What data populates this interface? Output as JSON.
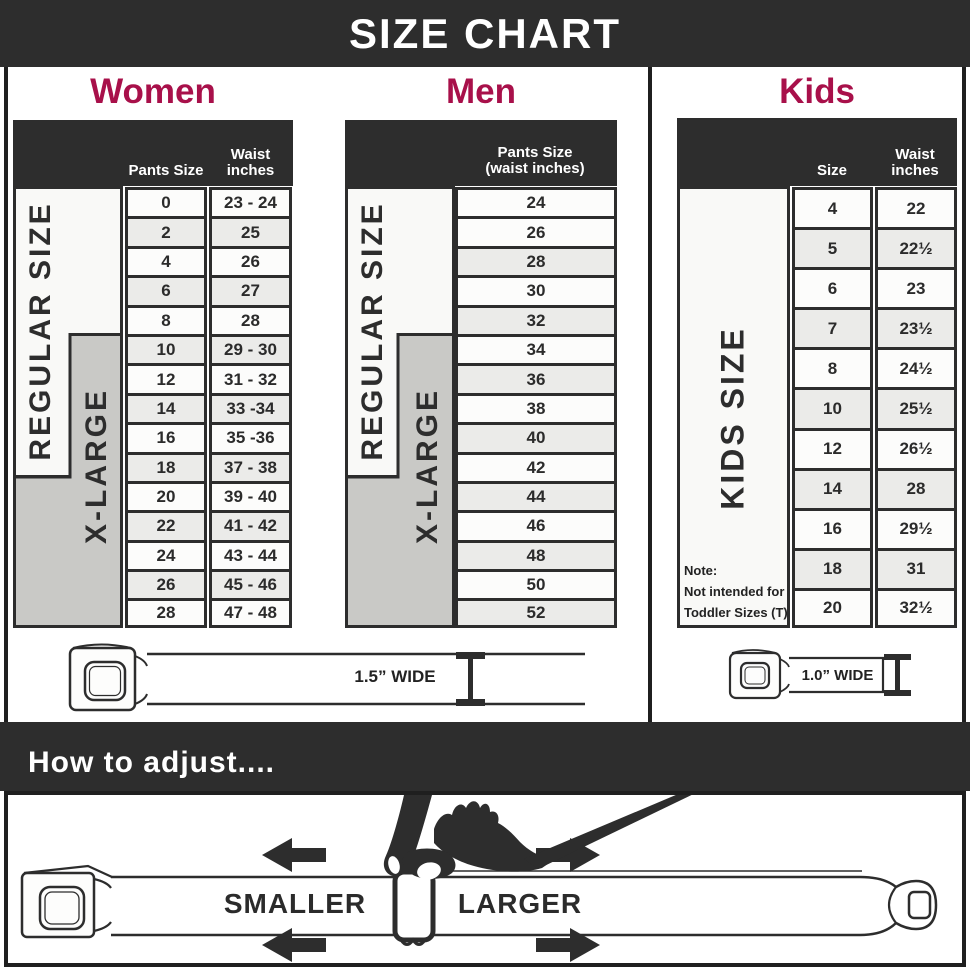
{
  "banner": {
    "title": "SIZE CHART"
  },
  "sections": {
    "women": {
      "heading": "Women",
      "col1_header": "Pants Size",
      "col2_header_line1": "Waist",
      "col2_header_line2": "inches",
      "regular_label": "REGULAR SIZE",
      "xlarge_label": "X-LARGE",
      "belt_width_label": "1.5” WIDE"
    },
    "men": {
      "heading": "Men",
      "header_line1": "Pants Size",
      "header_line2": "(waist inches)",
      "regular_label": "REGULAR SIZE",
      "xlarge_label": "X-LARGE"
    },
    "kids": {
      "heading": "Kids",
      "col1_header": "Size",
      "col2_header_line1": "Waist",
      "col2_header_line2": "inches",
      "label": "KIDS SIZE",
      "note_line1": "Note:",
      "note_line2": "Not intended for",
      "note_line3": "Toddler Sizes (T)",
      "belt_width_label": "1.0” WIDE"
    }
  },
  "adjust": {
    "heading": "How to adjust....",
    "smaller_label": "SMALLER",
    "larger_label": "LARGER"
  },
  "colors": {
    "accent_red": "#A8104A",
    "dark": "#2D2D2D",
    "gray_box": "#C9C9C6",
    "cell_alt": "#EBEBE9"
  },
  "chart_data": [
    {
      "type": "table",
      "title": "Women",
      "columns": [
        "Pants Size",
        "Waist inches"
      ],
      "row_groups": [
        "REGULAR SIZE",
        "X-LARGE"
      ],
      "rows": [
        [
          "0",
          "23 - 24"
        ],
        [
          "2",
          "25"
        ],
        [
          "4",
          "26"
        ],
        [
          "6",
          "27"
        ],
        [
          "8",
          "28"
        ],
        [
          "10",
          "29 - 30"
        ],
        [
          "12",
          "31 - 32"
        ],
        [
          "14",
          "33 -34"
        ],
        [
          "16",
          "35 -36"
        ],
        [
          "18",
          "37 - 38"
        ],
        [
          "20",
          "39 - 40"
        ],
        [
          "22",
          "41 - 42"
        ],
        [
          "24",
          "43 - 44"
        ],
        [
          "26",
          "45 - 46"
        ],
        [
          "28",
          "47 - 48"
        ]
      ]
    },
    {
      "type": "table",
      "title": "Men",
      "columns": [
        "Pants Size (waist inches)"
      ],
      "row_groups": [
        "REGULAR SIZE",
        "X-LARGE"
      ],
      "rows": [
        [
          "24"
        ],
        [
          "26"
        ],
        [
          "28"
        ],
        [
          "30"
        ],
        [
          "32"
        ],
        [
          "34"
        ],
        [
          "36"
        ],
        [
          "38"
        ],
        [
          "40"
        ],
        [
          "42"
        ],
        [
          "44"
        ],
        [
          "46"
        ],
        [
          "48"
        ],
        [
          "50"
        ],
        [
          "52"
        ]
      ]
    },
    {
      "type": "table",
      "title": "Kids",
      "columns": [
        "Size",
        "Waist inches"
      ],
      "row_groups": [
        "KIDS SIZE"
      ],
      "rows": [
        [
          "4",
          "22"
        ],
        [
          "5",
          "22½"
        ],
        [
          "6",
          "23"
        ],
        [
          "7",
          "23½"
        ],
        [
          "8",
          "24½"
        ],
        [
          "10",
          "25½"
        ],
        [
          "12",
          "26½"
        ],
        [
          "14",
          "28"
        ],
        [
          "16",
          "29½"
        ],
        [
          "18",
          "31"
        ],
        [
          "20",
          "32½"
        ]
      ]
    }
  ]
}
